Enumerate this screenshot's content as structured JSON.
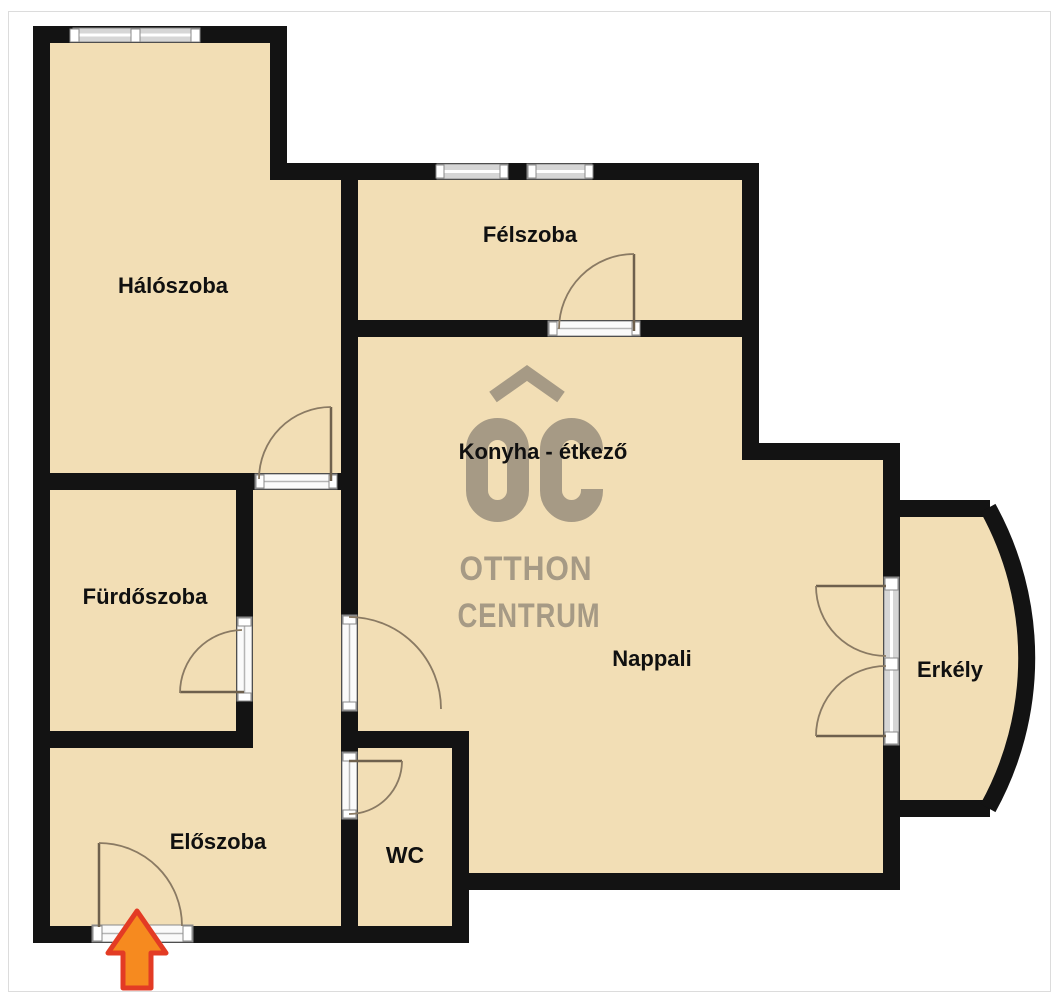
{
  "image": {
    "type": "floor-plan"
  },
  "colors": {
    "floor": "#f2deb5",
    "wall": "#131313",
    "window_fill": "#d6d6d6",
    "frame_stroke": "#8a8a8a",
    "door_swing": "#8a7a63",
    "door_leaf": "#6e604d",
    "watermark": "#a69a85",
    "arrow_fill": "#f68a1f",
    "arrow_border": "#e33b24"
  },
  "rooms": {
    "haloszoba": {
      "label": "Hálószoba"
    },
    "felszoba": {
      "label": "Félszoba"
    },
    "konyha_etkezo": {
      "label": "Konyha - étkező"
    },
    "furdoszoba": {
      "label": "Fürdőszoba"
    },
    "eloszoba": {
      "label": "Előszoba"
    },
    "wc": {
      "label": "WC"
    },
    "nappali": {
      "label": "Nappali"
    },
    "erkely": {
      "label": "Erkély"
    }
  },
  "watermark": {
    "mark": "OC",
    "line1": "OTTHON",
    "line2": "CENTRUM"
  }
}
